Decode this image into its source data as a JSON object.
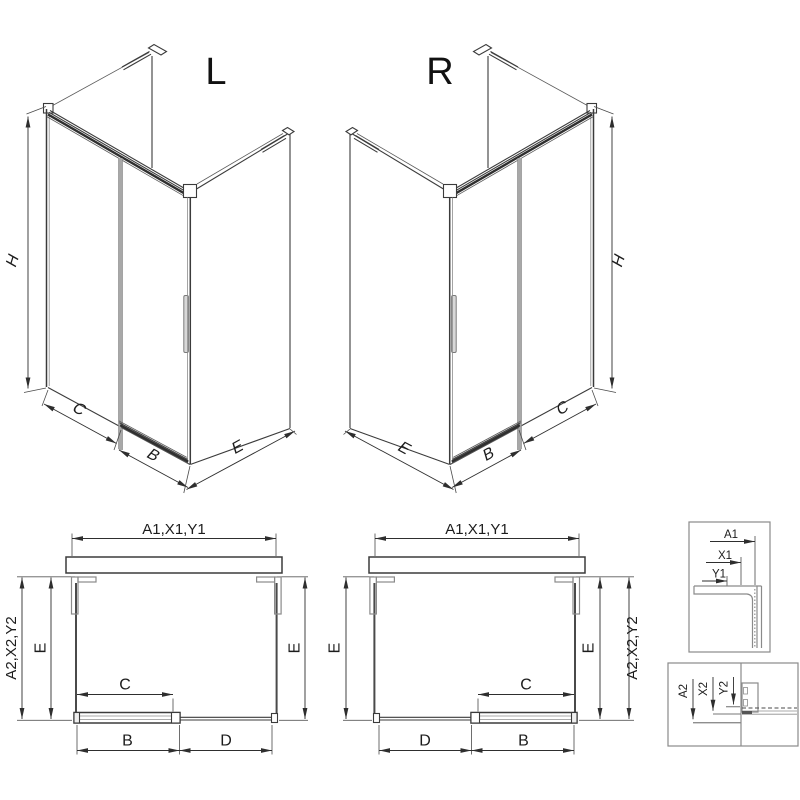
{
  "drawing": {
    "type": "technical-diagram",
    "subject": "walk-in shower enclosure, left (L) and right (R) versions, isometric views, plan views and mounting-profile details"
  },
  "colors": {
    "background": "#ffffff",
    "line": "#3b3b3b",
    "dimension": "#2e2e2e",
    "door_gray": "#a8a8a8",
    "detail_box": "#8a8a8a"
  },
  "iso_left": {
    "title": "L",
    "h": "H",
    "c": "C",
    "b": "B",
    "e": "E"
  },
  "iso_right": {
    "title": "R",
    "h": "H",
    "c": "C",
    "b": "B",
    "e": "E"
  },
  "plan_left": {
    "top_dim": "A1,X1,Y1",
    "outer_dim": "A2,X2,Y2",
    "e_left": "E",
    "e_right": "E",
    "c": "C",
    "b": "B",
    "d": "D"
  },
  "plan_right": {
    "top_dim": "A1,X1,Y1",
    "outer_dim": "A2,X2,Y2",
    "e_left": "E",
    "e_right": "E",
    "c": "C",
    "b": "B",
    "d": "D"
  },
  "detail_top": {
    "a1": "A1",
    "x1": "X1",
    "y1": "Y1"
  },
  "detail_bottom": {
    "a2": "A2",
    "x2": "X2",
    "y2": "Y2"
  }
}
